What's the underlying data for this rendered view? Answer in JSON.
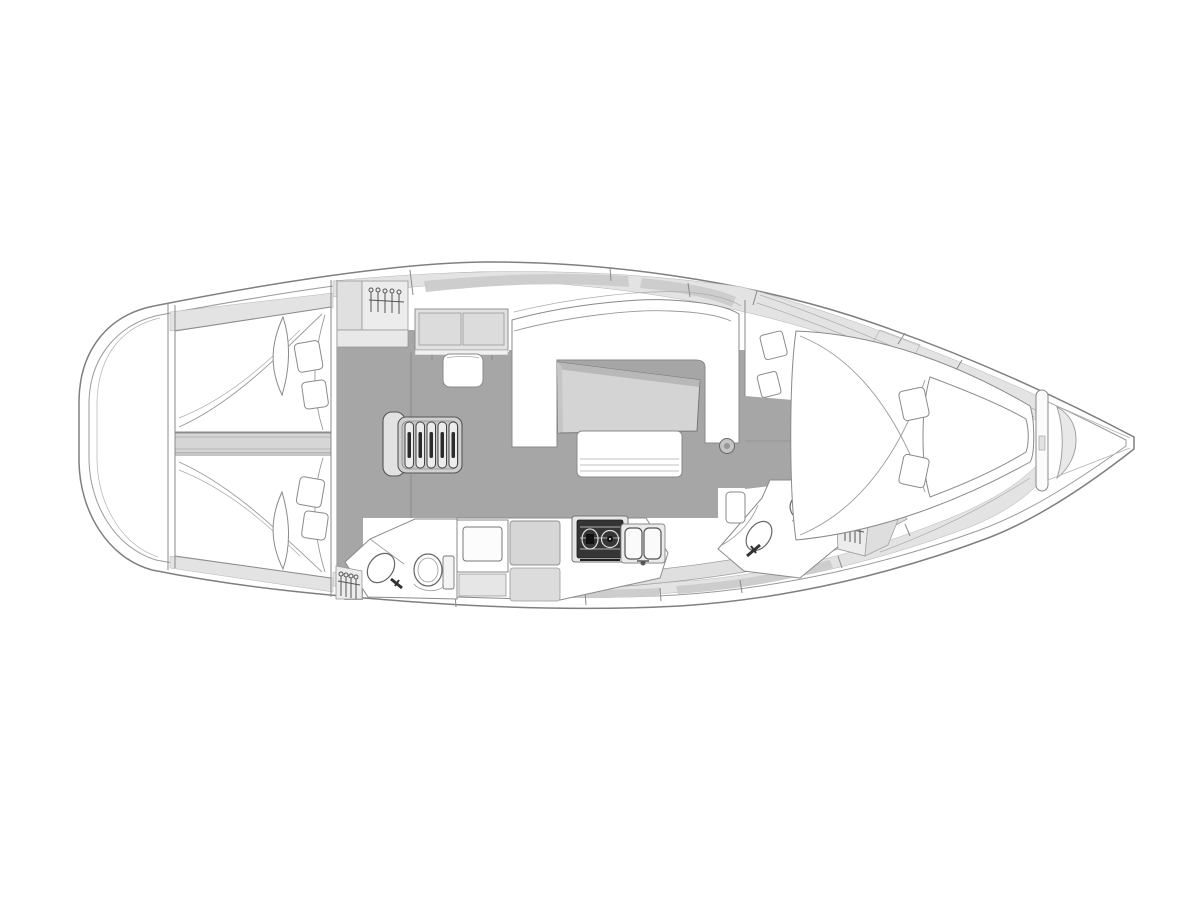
{
  "diagram": {
    "label": "Sailing yacht interior layout plan, bow to the right",
    "type": "floor-plan",
    "orientation": "bow-right",
    "colors": {
      "background": "#ffffff",
      "hull_fill": "#ffffff",
      "hull_outline": "#7f7f7f",
      "soft_line": "#9a9a9a",
      "deck_band": "#e3e3e3",
      "window_tint": "#cdcdcd",
      "floor": "#a6a6a6",
      "furniture": "#d6d6d6",
      "locker": "#ececec",
      "appliance_dark": "#353535",
      "accent_mid": "#c4c4c4"
    },
    "regions": [
      {
        "id": "stern-platform"
      },
      {
        "id": "aft-cabin-port",
        "furniture": [
          "double-berth",
          "pillows"
        ]
      },
      {
        "id": "aft-cabin-starboard",
        "furniture": [
          "double-berth",
          "pillows"
        ]
      },
      {
        "id": "engine-compartment"
      },
      {
        "id": "companionway-steps",
        "steps": 5
      },
      {
        "id": "nav-cabinet"
      },
      {
        "id": "wardrobe-aft-top"
      },
      {
        "id": "salon",
        "furniture": [
          "u-settee",
          "table",
          "bench-seat",
          "mast-post"
        ]
      },
      {
        "id": "galley",
        "furniture": [
          "refrigerator",
          "counter",
          "stove-2-burner",
          "double-sink"
        ]
      },
      {
        "id": "aft-head",
        "furniture": [
          "toilet",
          "sink",
          "wardrobe"
        ]
      },
      {
        "id": "forward-head",
        "furniture": [
          "toilet",
          "sink",
          "cabinet"
        ]
      },
      {
        "id": "forward-wardrobe"
      },
      {
        "id": "forward-cabin",
        "furniture": [
          "v-berth",
          "pillows",
          "side-shelves"
        ]
      },
      {
        "id": "anchor-locker"
      },
      {
        "id": "bow"
      }
    ]
  }
}
